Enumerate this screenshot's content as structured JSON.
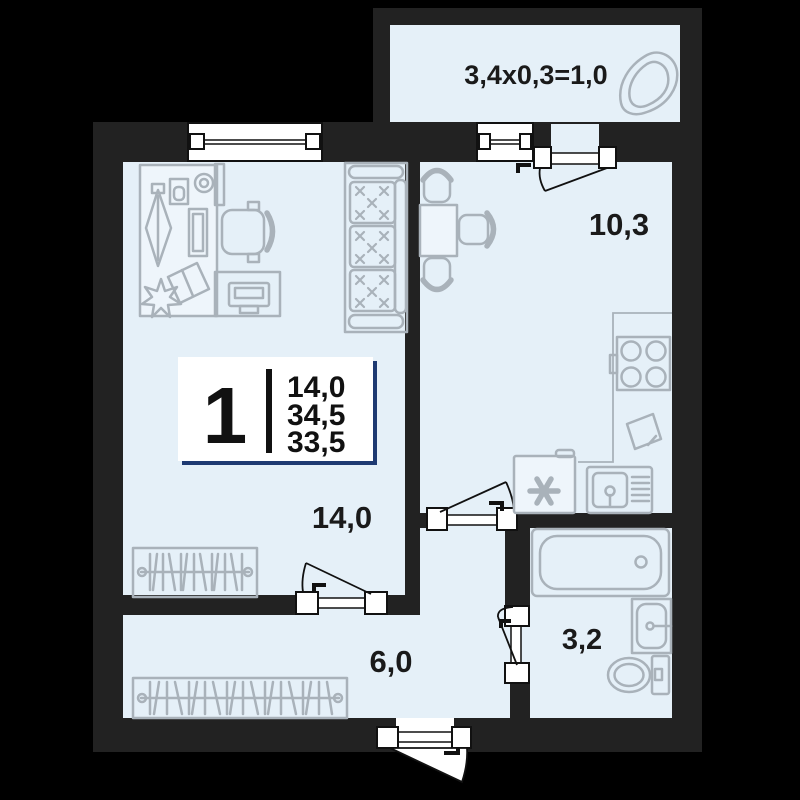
{
  "plan": {
    "colors": {
      "background": "#000000",
      "wall": "#222222",
      "floor": "#e5f0f8",
      "furniture_line": "#a9b2ba",
      "text": "#1a1a1a",
      "badge_accent": "#1e3a72"
    },
    "labels": {
      "kitchen_area": "10,3",
      "living_area": "14,0",
      "hall_area": "6,0",
      "bathroom_area": "3,2",
      "balcony_formula": "3,4x0,3=1,0"
    },
    "badge": {
      "rooms": "1",
      "living_area": "14,0",
      "total_area": "34,5",
      "area_without_balcony": "33,5"
    }
  }
}
